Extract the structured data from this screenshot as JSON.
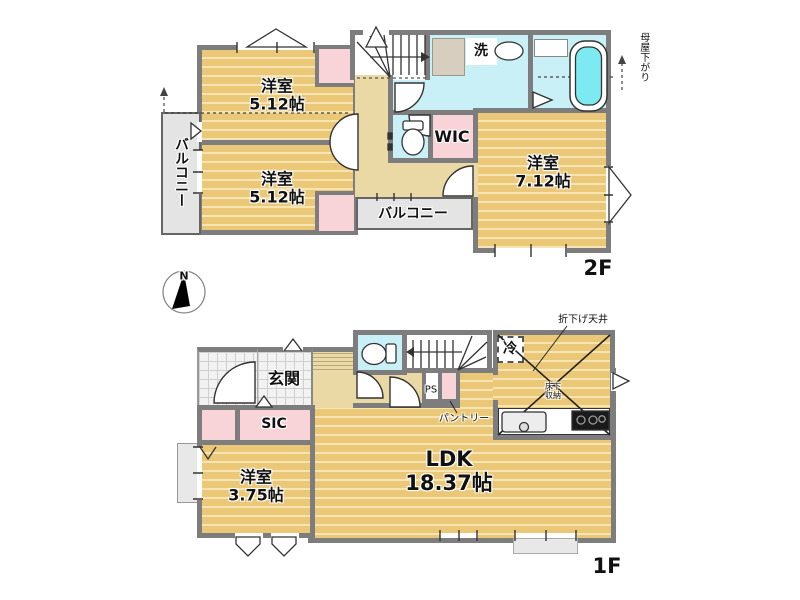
{
  "f2": {
    "floor_label": "2F",
    "room1_name": "洋室",
    "room1_size": "5.12帖",
    "room2_name": "洋室",
    "room2_size": "5.12帖",
    "room3_name": "洋室",
    "room3_size": "7.12帖",
    "wic": "WIC",
    "laundry": "洗",
    "balcony_left": "バルコニー",
    "balcony_mid": "バルコニー",
    "moya_sagari": "母屋下がり"
  },
  "f1": {
    "floor_label": "1F",
    "genkan": "玄関",
    "sic": "SIC",
    "room4_name": "洋室",
    "room4_size": "3.75帖",
    "ldk_name": "LDK",
    "ldk_size": "18.37帖",
    "fridge": "冷",
    "floor_storage_1": "床下",
    "floor_storage_2": "収納",
    "dropped_ceiling": "折下げ天井",
    "pantry": "パントリー",
    "pipe_space": "PS"
  },
  "compass": {
    "north": "N"
  },
  "colors": {
    "wall": "#7d7d7d",
    "room_floor": "#eac878",
    "floor_stripe": "#f6e5b3",
    "closet_pink": "#f8d3d8",
    "wet_area_cyan": "#c9f0f7",
    "hall_tan": "#ead9a4",
    "balcony_grey": "#e4e4e4",
    "bathtub_cyan": "#7de9f0"
  }
}
